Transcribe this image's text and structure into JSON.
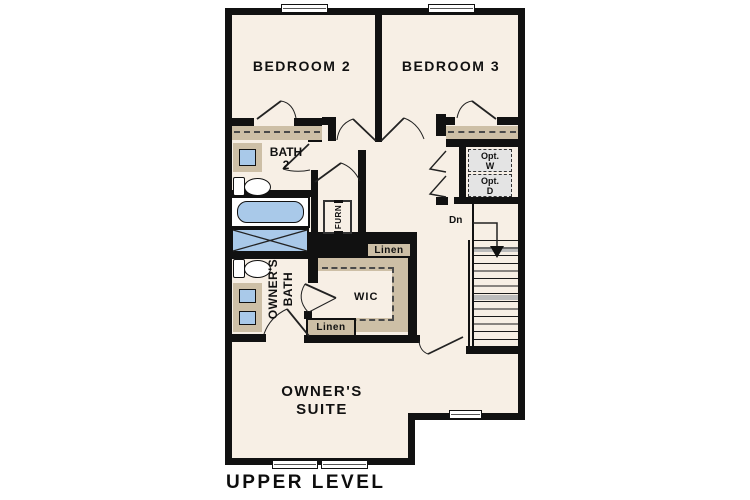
{
  "plan_title": "UPPER LEVEL",
  "rooms": {
    "bedroom2": {
      "label": "BEDROOM 2"
    },
    "bedroom3": {
      "label": "BEDROOM 3"
    },
    "bath2": {
      "line1": "BATH",
      "line2": "2"
    },
    "owners_bath": {
      "line1": "OWNER'S",
      "line2": "BATH"
    },
    "owners_suite": {
      "line1": "OWNER'S",
      "line2": "SUITE"
    },
    "wic": {
      "label": "WIC"
    },
    "laundry": {
      "label": "LAUNDRY"
    },
    "furnace": {
      "label": "FURN"
    },
    "linen_upper": {
      "label": "Linen"
    },
    "linen_lower": {
      "label": "Linen"
    },
    "stairs": {
      "down_label": "Dn"
    },
    "optional_washer": {
      "line1": "Opt.",
      "line2": "W"
    },
    "optional_dryer": {
      "line1": "Opt.",
      "line2": "D"
    }
  },
  "colors": {
    "wall": "#111111",
    "floor": "#f7efe5",
    "fixture_blue": "#a9c9e9",
    "cabinet_tan": "#cdbfa6",
    "appliance_gray": "#e4e4e4",
    "stair_tread_gray": "#bcbcbc"
  }
}
